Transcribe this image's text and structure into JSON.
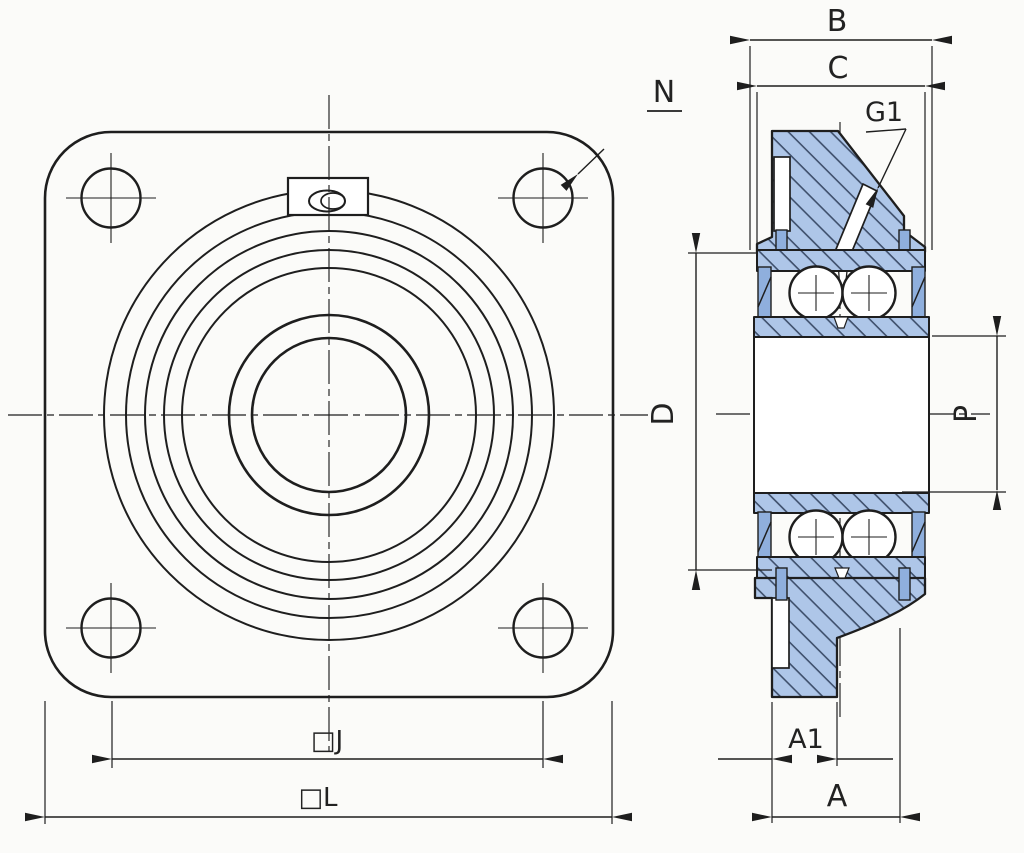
{
  "drawing": {
    "kind": "bearing-flange-unit-technical-drawing",
    "views": {
      "front": {
        "dims": {
          "j": "□J",
          "l": "□L"
        },
        "callouts": {
          "n": "N"
        }
      },
      "section": {
        "dims": {
          "b": "B",
          "c": "C",
          "d": "D",
          "p": "P",
          "a1": "A1",
          "a": "A"
        },
        "callouts": {
          "g1": "G1"
        }
      }
    },
    "colors": {
      "line": "#1e1e1e",
      "fill": "#aec6e8",
      "hatch": "#3e4f6b",
      "seal": "#8fafdd",
      "bg": "#fbfbf9"
    }
  }
}
